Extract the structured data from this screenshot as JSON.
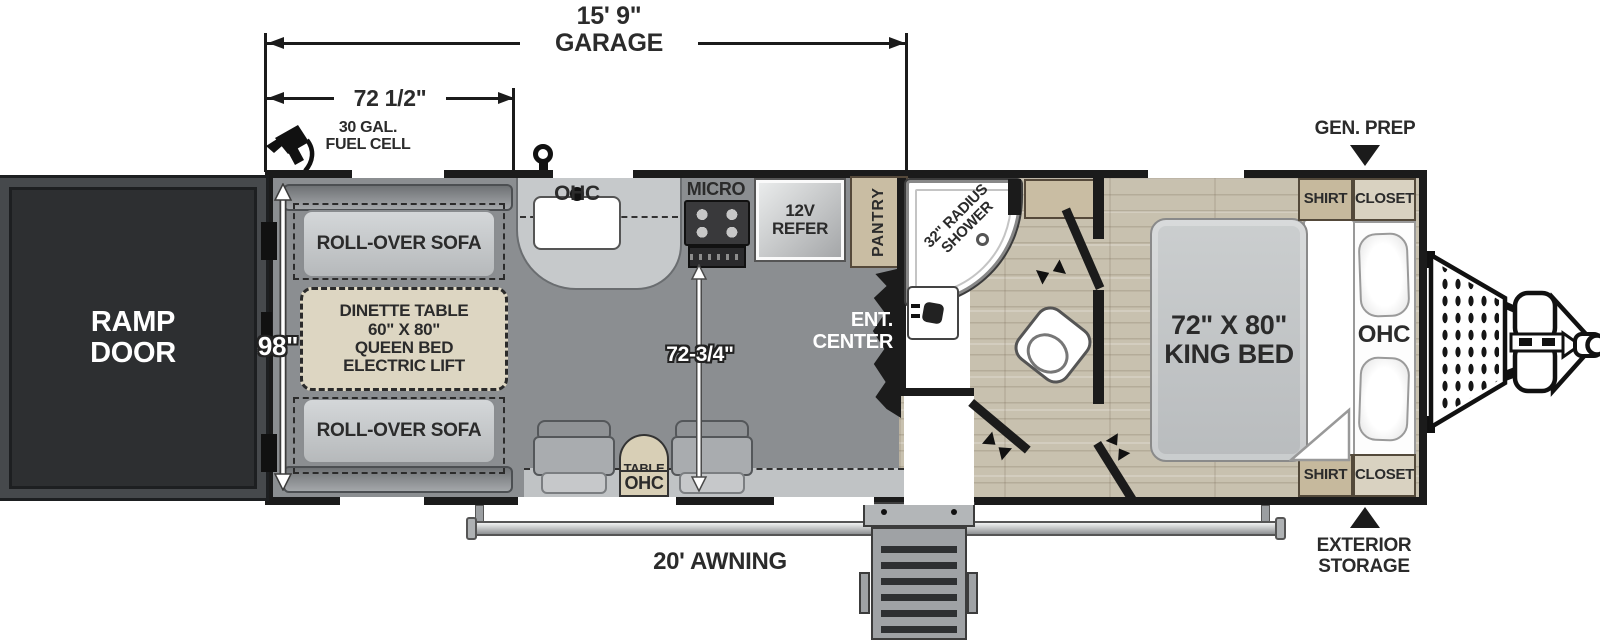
{
  "colors": {
    "wall": "#1b1b1b",
    "garage_floor": "#8b8e91",
    "wood_floor": "#c8c1af",
    "cabinet_tan": "#c9bda3",
    "closet_light": "#d9d2c1",
    "dinette_tan": "#ddd6c2",
    "sofa_gray": "#a7abae",
    "white": "#ffffff"
  },
  "dims": {
    "garage_len": [
      "15' 9\"",
      "GARAGE"
    ],
    "front_len": "72 1/2\"",
    "width": "98\"",
    "garage_opening": "72-3/4\"",
    "awning": "20' AWNING"
  },
  "labels": {
    "ramp_door": [
      "RAMP",
      "DOOR"
    ],
    "fuel": [
      "30 GAL.",
      "FUEL CELL"
    ],
    "gen_prep": "GEN. PREP",
    "ext_storage": [
      "EXTERIOR",
      "STORAGE"
    ]
  },
  "garage": {
    "sofa_top": "ROLL-OVER SOFA",
    "sofa_bottom": "ROLL-OVER SOFA",
    "dinette": [
      "DINETTE TABLE",
      "60\" X 80\"",
      "QUEEN BED",
      "ELECTRIC LIFT"
    ],
    "ohc_sink": "OHC",
    "micro": "MICRO",
    "refer": [
      "12V",
      "REFER"
    ],
    "pantry": "PANTRY",
    "ent_center": [
      "ENT.",
      "CENTER"
    ],
    "table": "TABLE",
    "table_ohc": "OHC"
  },
  "bath": {
    "shower": [
      "32\" RADIUS",
      "SHOWER"
    ]
  },
  "bedroom": {
    "bed": [
      "72\" X 80\"",
      "KING BED"
    ],
    "ohc": "OHC",
    "closet_top": [
      "SHIRT",
      "CLOSET"
    ],
    "closet_bottom": [
      "SHIRT",
      "CLOSET"
    ]
  }
}
